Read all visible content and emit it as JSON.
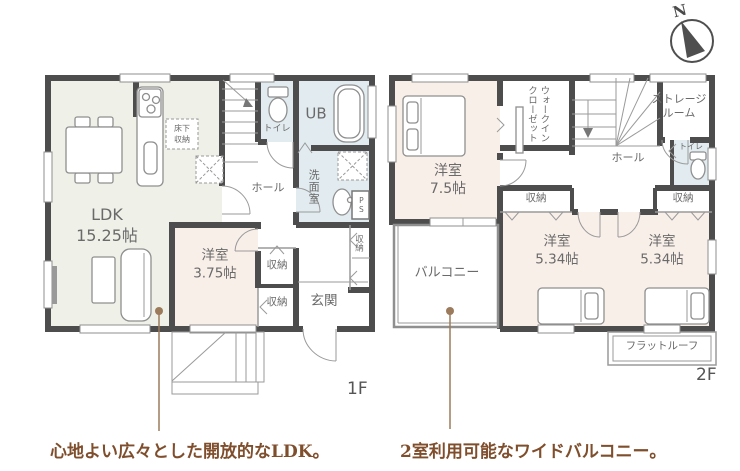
{
  "colors": {
    "wall": "#4d4d4d",
    "ldk_fill": "#eff0e8",
    "bedroom_fill": "#f9efe9",
    "bath_fill": "#e2ecf0",
    "outline": "#9a9a9a",
    "label_text": "#6a6a6a",
    "floor_label_text": "#555555",
    "annotation_text": "#7f4e2c",
    "annotation_line": "#9c7b5c"
  },
  "compass": {
    "north_label": "N"
  },
  "floor1": {
    "floor_label": "1F",
    "rooms": {
      "ldk": "LDK\n15.25帖",
      "bedroom": "洋室\n3.75帖",
      "underfloor_storage": "床下\n収納",
      "toilet": "トイレ",
      "unit_bath": "UB",
      "washroom": "洗面室",
      "hall": "ホール",
      "pipe_space": "PS",
      "closet_side": "収納",
      "closet_upper": "収納",
      "closet_lower": "収納",
      "entrance": "玄関"
    }
  },
  "floor2": {
    "floor_label": "2F",
    "rooms": {
      "main_bedroom": "洋室\n7.5帖",
      "walk_in_closet": "ウォークイン\nクローゼット",
      "storage_room": "ストレージ\nルーム",
      "hall": "ホール",
      "toilet": "トイレ",
      "closet_left": "収納",
      "closet_right": "収納",
      "bedroom_center": "洋室\n5.34帖",
      "bedroom_right": "洋室\n5.34帖",
      "balcony": "バルコニー",
      "flat_roof": "フラットルーフ"
    }
  },
  "annotations": {
    "ldk_note": "心地よい広々とした開放的なLDK。",
    "balcony_note": "2室利用可能なワイドバルコニー。"
  }
}
